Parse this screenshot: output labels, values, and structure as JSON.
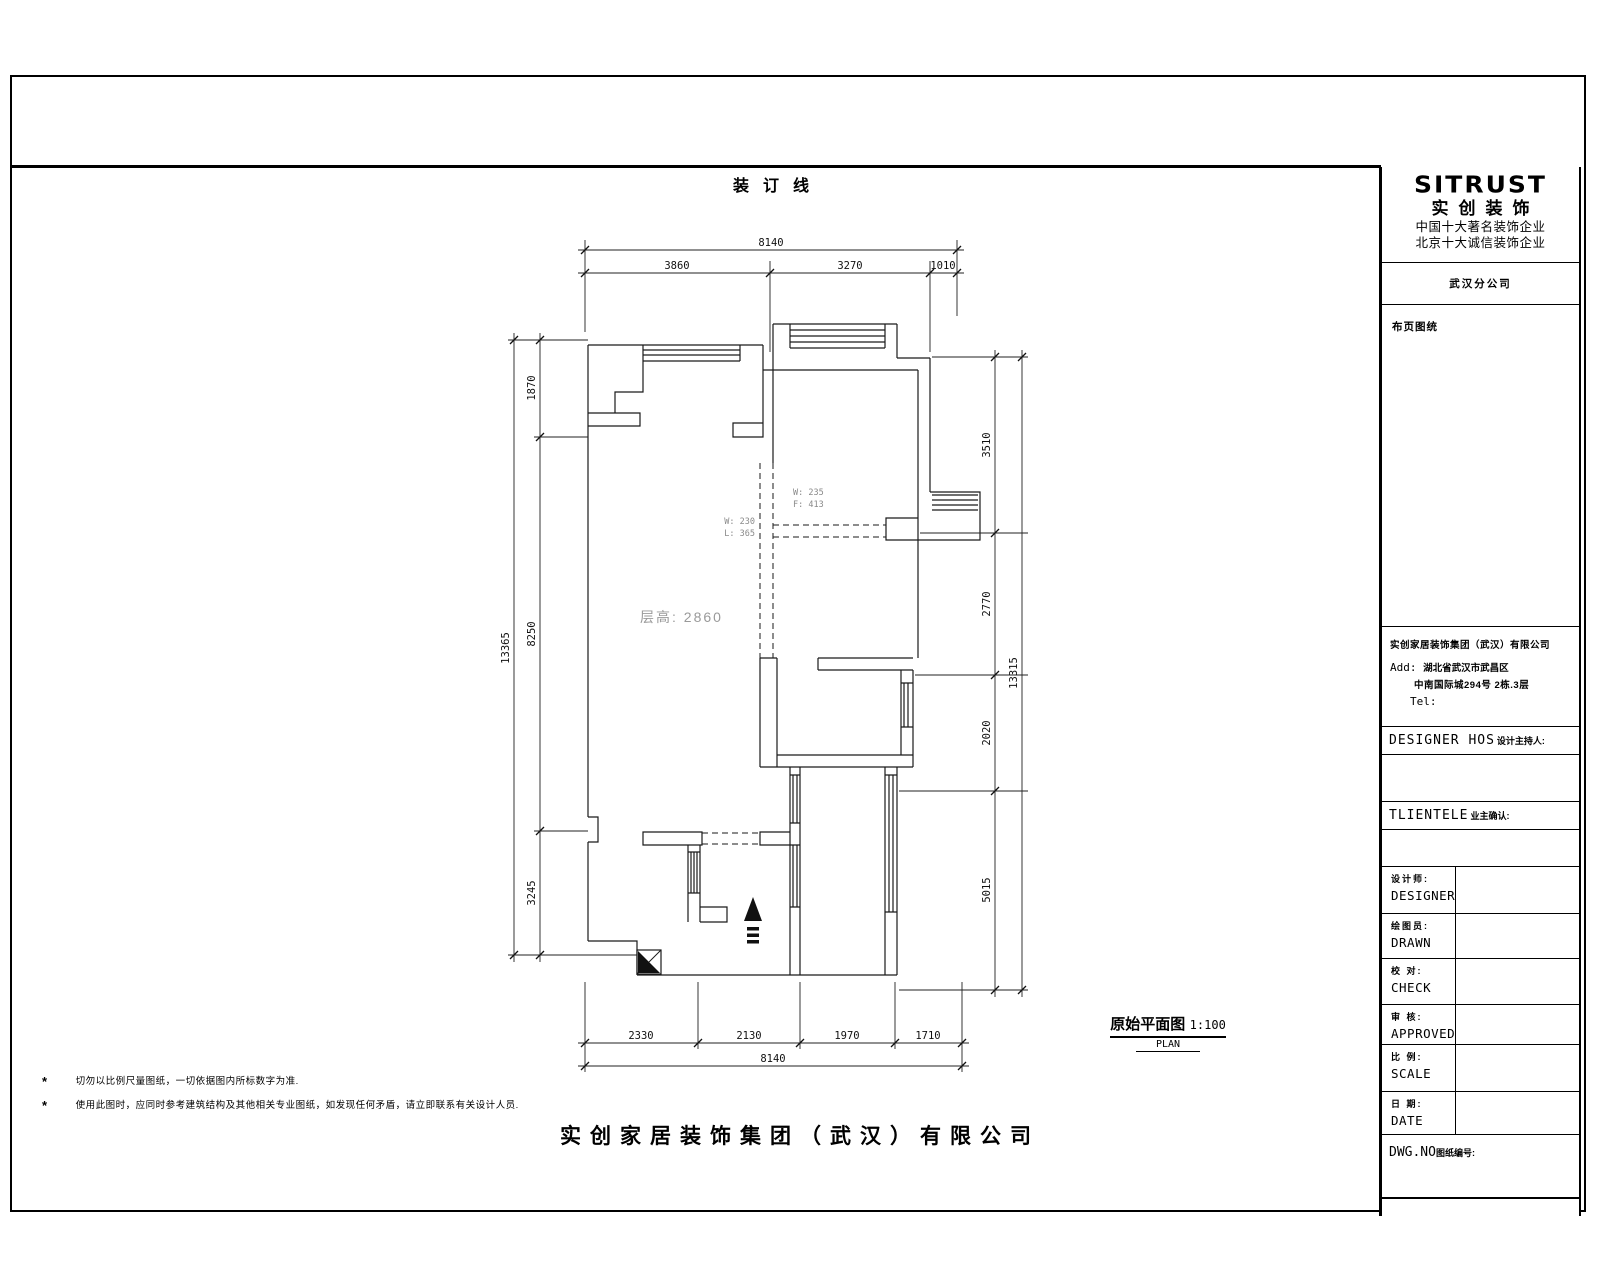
{
  "sheet": {
    "binding_label": "装订线",
    "bottom_company": "实创家居装饰集团（武汉）有限公司",
    "notes": [
      {
        "star": "*",
        "text": "切勿以比例尺量图纸，一切依据图内所标数字为准."
      },
      {
        "star": "*",
        "text": "使用此图时，应同时参考建筑结构及其他相关专业图纸，如发现任何矛盾，请立即联系有关设计人员."
      }
    ]
  },
  "plan": {
    "title": "原始平面图",
    "scale": "1:100",
    "subtitle": "PLAN",
    "floor_height_label": "层高: 2860",
    "beam_labels": {
      "right_line1": "W: 235",
      "right_line2": "F: 413",
      "left_line1": "W: 230",
      "left_line2": "L: 365"
    },
    "dims": {
      "top_total": "8140",
      "top_seg_1": "3860",
      "top_seg_2": "3270",
      "top_seg_3": "1010",
      "left_total": "13365",
      "left_seg_1": "1870",
      "left_seg_2": "8250",
      "left_seg_3": "3245",
      "right_total": "13315",
      "right_seg_1": "3510",
      "right_seg_2": "2770",
      "right_seg_3": "2020",
      "right_seg_4": "5015",
      "bottom_total": "8140",
      "bottom_seg_1": "2330",
      "bottom_seg_2": "2130",
      "bottom_seg_3": "1970",
      "bottom_seg_4": "1710"
    }
  },
  "title_block": {
    "logo": "SITRUST",
    "brand": "实创装饰",
    "tagline1": "中国十大著名装饰企业",
    "tagline2": "北京十大诚信装饰企业",
    "branch": "武汉分公司",
    "page_label": "布页图统",
    "company": "实创家居装饰集团（武汉）有限公司",
    "addr_label": "Add:",
    "addr_line1": "湖北省武汉市武昌区",
    "addr_line2": "中南国际城294号  2栋.3层",
    "tel_label": "Tel:",
    "designer_host_en": "DESIGNER  HOS",
    "designer_host_cn": "设计主持人:",
    "clientele_en": "TLIENTELE",
    "clientele_cn": "业主确认:",
    "rows": [
      {
        "cn": "设计师:",
        "en": "DESIGNER"
      },
      {
        "cn": "绘图员:",
        "en": "DRAWN"
      },
      {
        "cn": "校 对:",
        "en": "CHECK"
      },
      {
        "cn": "审 核:",
        "en": "APPROVED"
      },
      {
        "cn": "比 例:",
        "en": "SCALE"
      },
      {
        "cn": "日 期:",
        "en": "DATE"
      }
    ],
    "dwg_en": "DWG.NO",
    "dwg_cn": "图纸编号:"
  }
}
